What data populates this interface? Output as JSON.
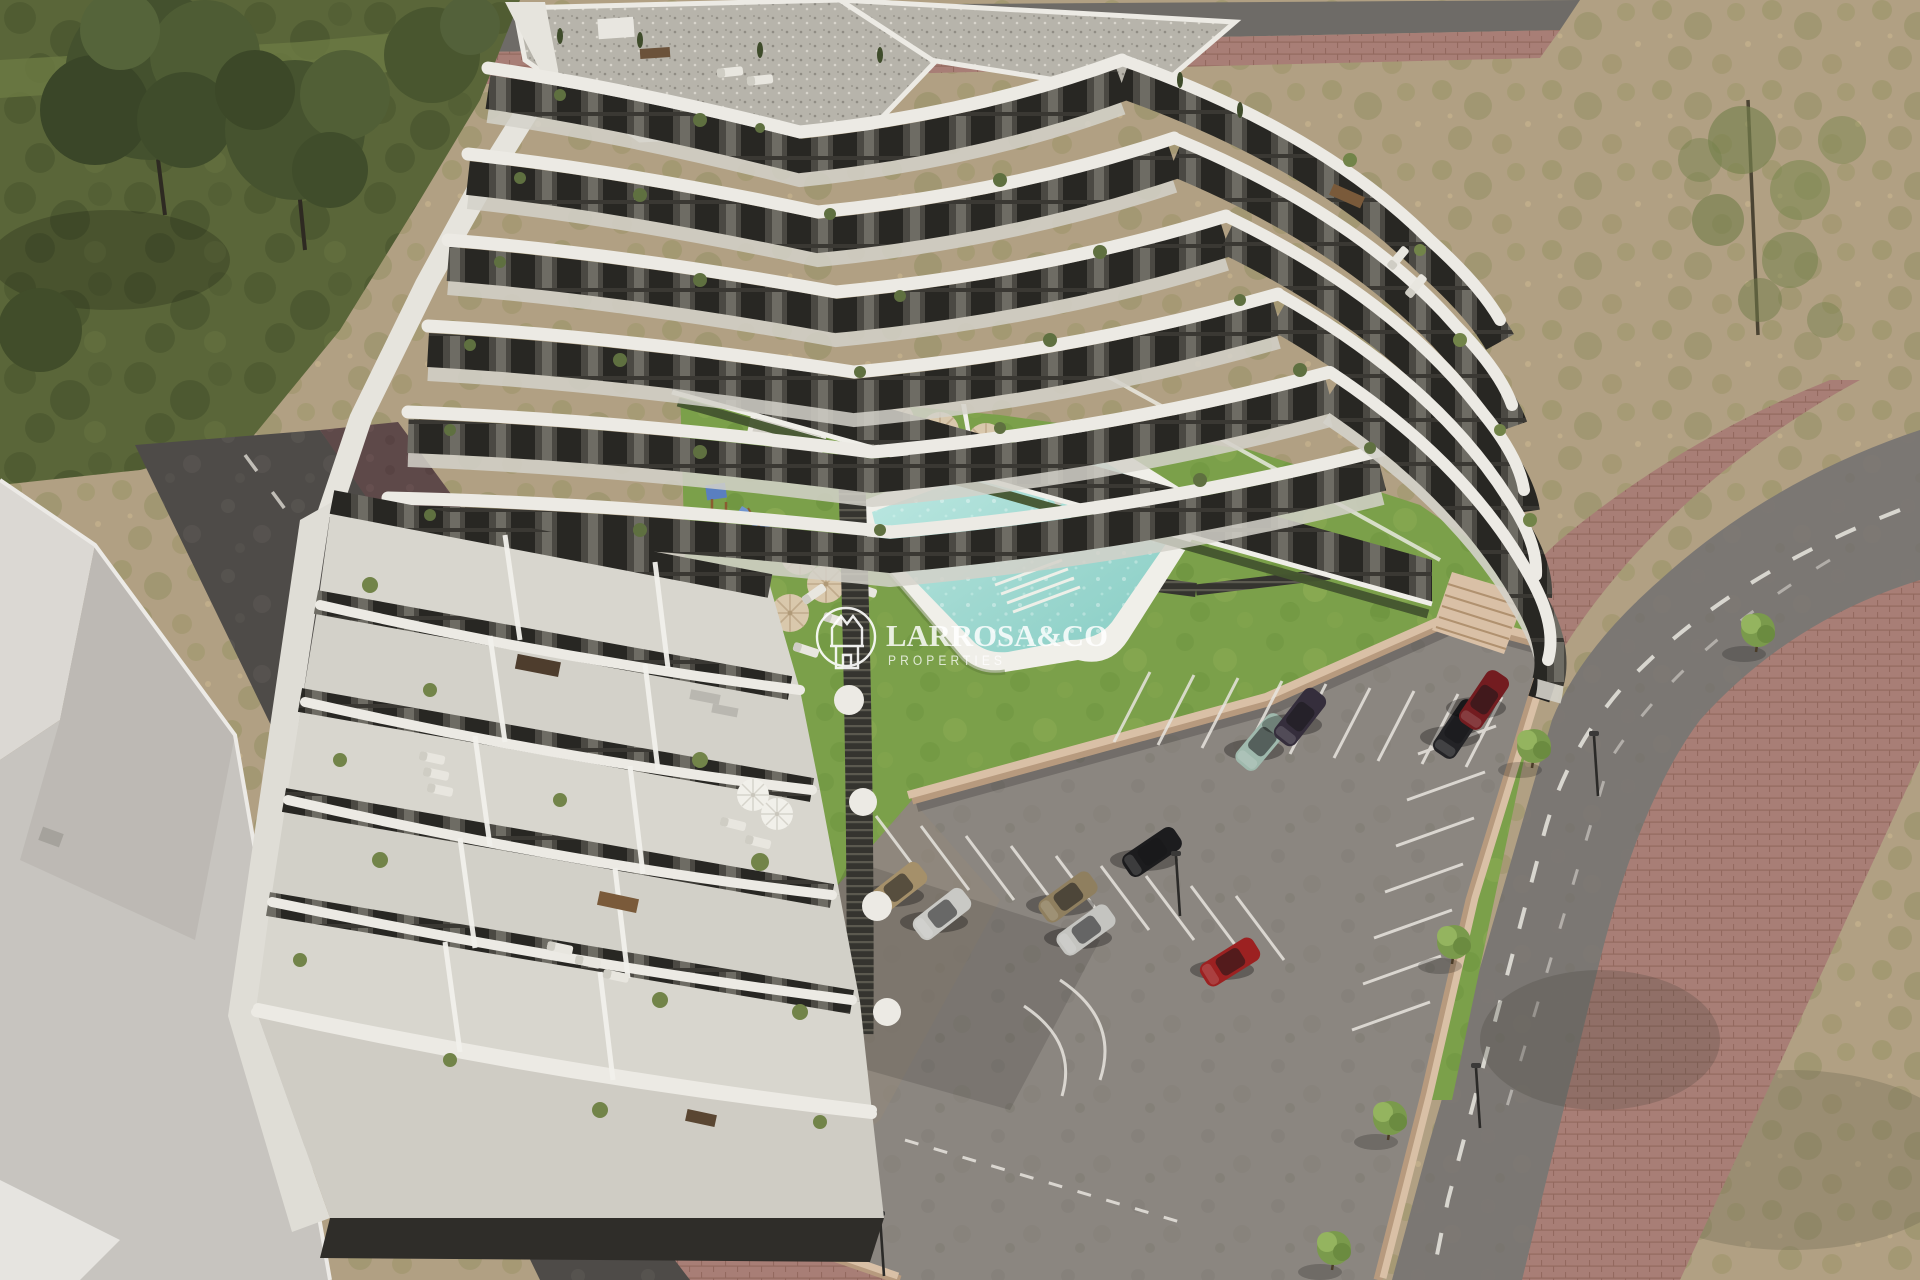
{
  "watermark": {
    "brand": "LARROSA&CO",
    "tagline": "PROPERTIES",
    "logo_icon": "crown-house-in-circle-icon",
    "color": "#ffffff"
  },
  "scene": {
    "type": "aerial-3d-architectural-render",
    "subject": "terraced white apartment complex with central courtyard, pool garden and private parking",
    "amenities": [
      "angular-swimming-pool",
      "round-spa-pool",
      "children-playground-with-blue-slide",
      "beige-parasols-with-sun-loungers",
      "white-parasols-on-terraces",
      "lawn-garden",
      "timber-slat-walkways",
      "garden-stairs",
      "striped-parking-bays"
    ],
    "vehicles": [
      {
        "color_name": "gold",
        "hex": "#a5906a"
      },
      {
        "color_name": "silver",
        "hex": "#c9c9c5"
      },
      {
        "color_name": "tan",
        "hex": "#8f7f5f"
      },
      {
        "color_name": "silver",
        "hex": "#c4c4c0"
      },
      {
        "color_name": "black",
        "hex": "#1c1c1e"
      },
      {
        "color_name": "red",
        "hex": "#9c2121"
      },
      {
        "color_name": "teal-suv",
        "hex": "#9fb9ad"
      },
      {
        "color_name": "dark-purple",
        "hex": "#352e3c"
      },
      {
        "color_name": "black",
        "hex": "#232326"
      },
      {
        "color_name": "dark-red",
        "hex": "#731c20"
      }
    ],
    "environment": [
      "dark-green-grass-field-with-trees-top-left",
      "bare-sandy-field-top-right",
      "perimeter-road-with-white-dashes",
      "red-brick-sidewalks-with-small-trees-and-lamps",
      "neighbouring-grey-rooftops-bottom-left"
    ]
  },
  "palette": {
    "dirt": "#b1a083",
    "dirt_mottle": "#93905e",
    "grass_dark": "#5a6639",
    "lawn": "#7ba04a",
    "pool_water": "#9fd8d0",
    "pool_deck": "#f0efe9",
    "building_white": "#eceae4",
    "building_wall_dark": "#4b4943",
    "terrace_floor": "#d8d6ce",
    "parking_asphalt": "#8b8680",
    "road_asphalt": "#7b7773",
    "street_dark": "#4e4b48",
    "brick_sidewalk": "#a87e76",
    "maroon_walk": "#5e4949",
    "tan_wall": "#d9c0a6",
    "neighbor_roof": "#c7c4bf",
    "watermark_white": "#ffffff"
  }
}
